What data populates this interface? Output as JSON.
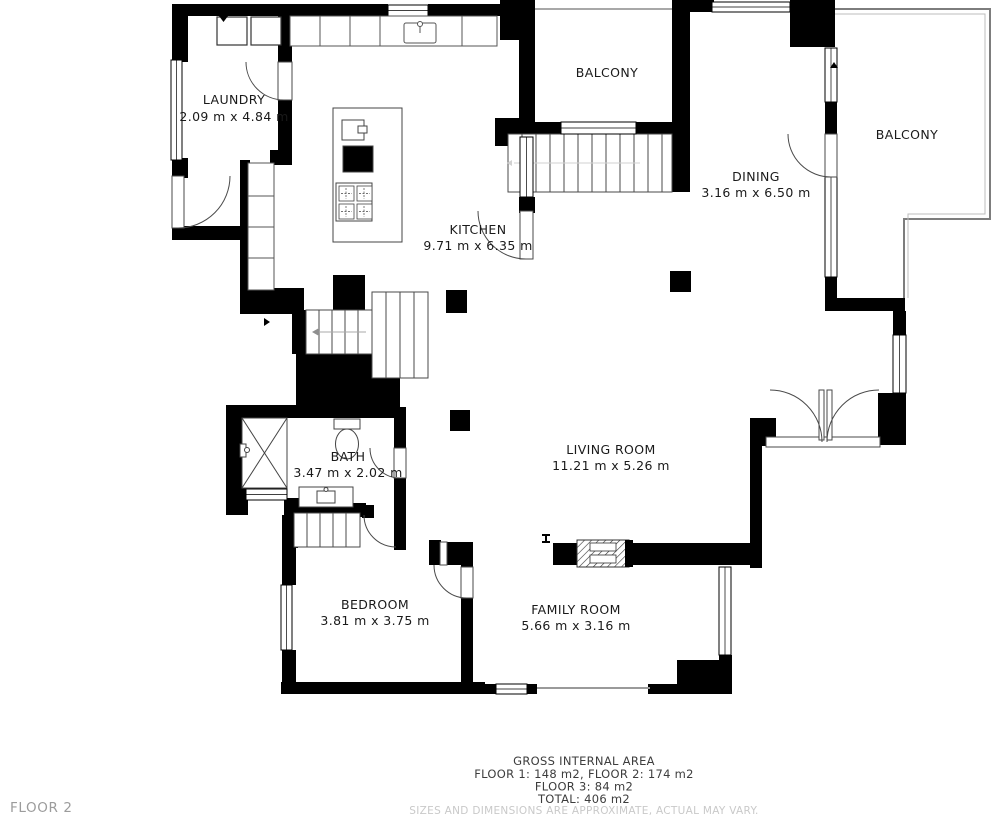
{
  "floor_label": "FLOOR 2",
  "rooms": {
    "laundry": {
      "name": "LAUNDRY",
      "dims": "2.09 m x 4.84 m"
    },
    "kitchen": {
      "name": "KITCHEN",
      "dims": "9.71 m x 6.35 m"
    },
    "balcony_top": {
      "name": "BALCONY"
    },
    "dining": {
      "name": "DINING",
      "dims": "3.16 m x 6.50 m"
    },
    "balcony_right": {
      "name": "BALCONY"
    },
    "living": {
      "name": "LIVING ROOM",
      "dims": "11.21 m x 5.26 m"
    },
    "bath": {
      "name": "BATH",
      "dims": "3.47 m x 2.02 m"
    },
    "bedroom": {
      "name": "BEDROOM",
      "dims": "3.81 m x 3.75 m"
    },
    "family": {
      "name": "FAMILY ROOM",
      "dims": "5.66 m x 3.16 m"
    }
  },
  "footer": {
    "title": "GROSS INTERNAL AREA",
    "line1": "FLOOR 1: 148 m2, FLOOR 2: 174 m2",
    "line2": "FLOOR 3: 84 m2",
    "line3": "TOTAL: 406 m2",
    "disclaimer": "SIZES AND DIMENSIONS ARE APPROXIMATE, ACTUAL MAY VARY."
  },
  "colors": {
    "wall": "#000000",
    "outline": "#4a4a4a",
    "balcony_line": "#8c8c8c",
    "text": "#1a1a1a",
    "footer_text": "#3d3d3d",
    "muted": "#c9c9c9",
    "floor_label": "#9c9c9c"
  }
}
